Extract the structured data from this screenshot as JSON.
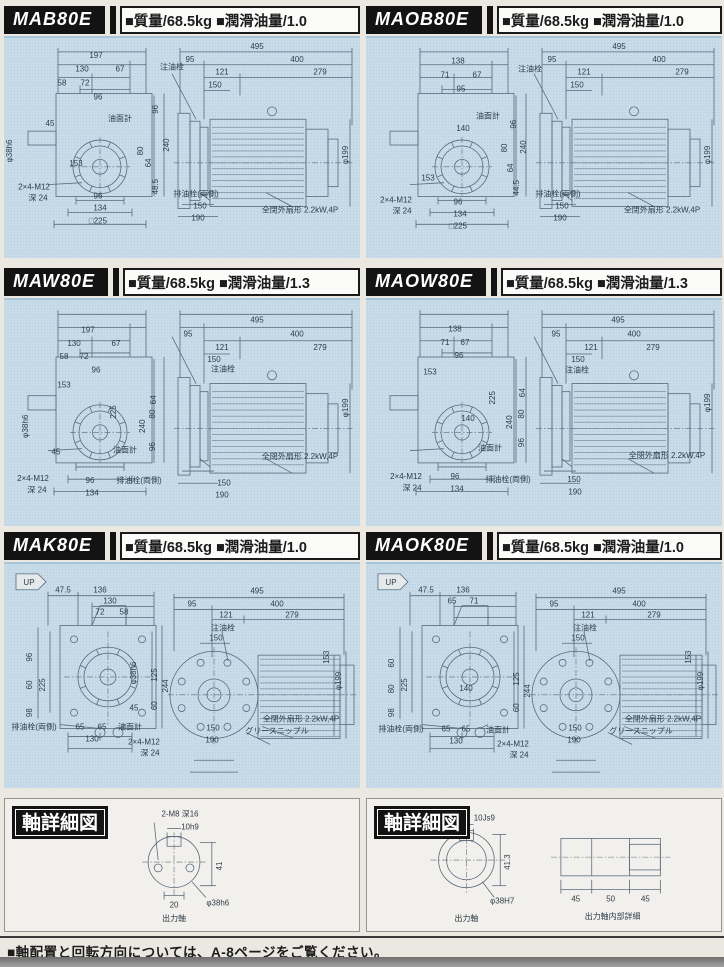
{
  "page": {
    "footer_note": "■軸配置と回転方向については、A-8ページをご覧ください。"
  },
  "colors": {
    "panel_bg": "#c7dbe9",
    "header_bg": "#131313",
    "line": "#5a6b7c",
    "label": "#2e3c49",
    "page_bg": "#ebe8e2"
  },
  "panels": [
    {
      "model": "MAB80E",
      "spec": "■質量/68.5kg ■潤滑油量/1.0",
      "family": "bw",
      "labels": [
        {
          "t": "197",
          "x": 92,
          "y": 22
        },
        {
          "t": "130",
          "x": 78,
          "y": 36
        },
        {
          "t": "67",
          "x": 116,
          "y": 36
        },
        {
          "t": "58",
          "x": 58,
          "y": 50
        },
        {
          "t": "72",
          "x": 81,
          "y": 50
        },
        {
          "t": "96",
          "x": 94,
          "y": 64
        },
        {
          "t": "注油栓",
          "x": 168,
          "y": 34
        },
        {
          "t": "45",
          "x": 46,
          "y": 91
        },
        {
          "t": "油面計",
          "x": 116,
          "y": 86
        },
        {
          "t": "φ38h6",
          "x": 8,
          "y": 116,
          "r": 1
        },
        {
          "t": "153",
          "x": 72,
          "y": 131
        },
        {
          "t": "2×4-M12",
          "x": 30,
          "y": 155
        },
        {
          "t": "深 24",
          "x": 34,
          "y": 166
        },
        {
          "t": "96",
          "x": 94,
          "y": 164
        },
        {
          "t": "134",
          "x": 96,
          "y": 176
        },
        {
          "t": "□225",
          "x": 94,
          "y": 189
        },
        {
          "t": "96",
          "x": 154,
          "y": 74,
          "r": 1
        },
        {
          "t": "240",
          "x": 165,
          "y": 110,
          "r": 1
        },
        {
          "t": "80",
          "x": 139,
          "y": 116,
          "r": 1
        },
        {
          "t": "64",
          "x": 147,
          "y": 128,
          "r": 1
        },
        {
          "t": "48.5",
          "x": 154,
          "y": 152,
          "r": 1
        },
        {
          "t": "495",
          "x": 253,
          "y": 13
        },
        {
          "t": "95",
          "x": 186,
          "y": 26
        },
        {
          "t": "400",
          "x": 293,
          "y": 26
        },
        {
          "t": "121",
          "x": 218,
          "y": 39
        },
        {
          "t": "279",
          "x": 316,
          "y": 39
        },
        {
          "t": "150",
          "x": 211,
          "y": 52
        },
        {
          "t": "φ199",
          "x": 344,
          "y": 120,
          "r": 1
        },
        {
          "t": "排油栓(両側)",
          "x": 192,
          "y": 162
        },
        {
          "t": "150",
          "x": 196,
          "y": 174
        },
        {
          "t": "190",
          "x": 194,
          "y": 186
        },
        {
          "t": "全閉外扇形 2.2kW,4P",
          "x": 296,
          "y": 178
        }
      ]
    },
    {
      "model": "MAOB80E",
      "spec": "■質量/68.5kg ■潤滑油量/1.0",
      "family": "bw",
      "labels": [
        {
          "t": "138",
          "x": 92,
          "y": 28
        },
        {
          "t": "71",
          "x": 79,
          "y": 42
        },
        {
          "t": "67",
          "x": 111,
          "y": 42
        },
        {
          "t": "95",
          "x": 95,
          "y": 56
        },
        {
          "t": "140",
          "x": 97,
          "y": 96
        },
        {
          "t": "油面計",
          "x": 122,
          "y": 83
        },
        {
          "t": "96",
          "x": 150,
          "y": 89,
          "r": 1
        },
        {
          "t": "80",
          "x": 141,
          "y": 113,
          "r": 1
        },
        {
          "t": "64",
          "x": 147,
          "y": 133,
          "r": 1
        },
        {
          "t": "240",
          "x": 160,
          "y": 112,
          "r": 1
        },
        {
          "t": "44.5",
          "x": 153,
          "y": 153,
          "r": 1
        },
        {
          "t": "153",
          "x": 62,
          "y": 146
        },
        {
          "t": "2×4-M12",
          "x": 30,
          "y": 168
        },
        {
          "t": "深 24",
          "x": 36,
          "y": 179
        },
        {
          "t": "96",
          "x": 92,
          "y": 170
        },
        {
          "t": "134",
          "x": 94,
          "y": 182
        },
        {
          "t": "□225",
          "x": 92,
          "y": 194
        },
        {
          "t": "注油栓",
          "x": 164,
          "y": 36
        },
        {
          "t": "495",
          "x": 253,
          "y": 13
        },
        {
          "t": "95",
          "x": 186,
          "y": 26
        },
        {
          "t": "400",
          "x": 293,
          "y": 26
        },
        {
          "t": "121",
          "x": 218,
          "y": 39
        },
        {
          "t": "279",
          "x": 316,
          "y": 39
        },
        {
          "t": "150",
          "x": 211,
          "y": 52
        },
        {
          "t": "φ199",
          "x": 344,
          "y": 120,
          "r": 1
        },
        {
          "t": "排油栓(両側)",
          "x": 192,
          "y": 162
        },
        {
          "t": "150",
          "x": 196,
          "y": 174
        },
        {
          "t": "190",
          "x": 194,
          "y": 186
        },
        {
          "t": "全閉外扇形 2.2kW,4P",
          "x": 296,
          "y": 178
        }
      ]
    },
    {
      "model": "MAW80E",
      "spec": "■質量/68.5kg ■潤滑油量/1.3",
      "family": "bw",
      "labels": [
        {
          "t": "197",
          "x": 84,
          "y": 34
        },
        {
          "t": "130",
          "x": 70,
          "y": 47
        },
        {
          "t": "67",
          "x": 112,
          "y": 47
        },
        {
          "t": "58",
          "x": 60,
          "y": 60
        },
        {
          "t": "72",
          "x": 80,
          "y": 60
        },
        {
          "t": "96",
          "x": 92,
          "y": 73
        },
        {
          "t": "153",
          "x": 60,
          "y": 88
        },
        {
          "t": "225",
          "x": 112,
          "y": 112,
          "r": 1
        },
        {
          "t": "φ38h6",
          "x": 24,
          "y": 126,
          "r": 1
        },
        {
          "t": "45",
          "x": 52,
          "y": 154
        },
        {
          "t": "2×4-M12",
          "x": 29,
          "y": 180
        },
        {
          "t": "深 24",
          "x": 33,
          "y": 191
        },
        {
          "t": "96",
          "x": 86,
          "y": 182
        },
        {
          "t": "134",
          "x": 88,
          "y": 194
        },
        {
          "t": "油面計",
          "x": 121,
          "y": 152
        },
        {
          "t": "排油栓(両側)",
          "x": 135,
          "y": 182
        },
        {
          "t": "64",
          "x": 152,
          "y": 100,
          "r": 1
        },
        {
          "t": "80",
          "x": 151,
          "y": 114,
          "r": 1
        },
        {
          "t": "240",
          "x": 141,
          "y": 126,
          "r": 1
        },
        {
          "t": "96",
          "x": 151,
          "y": 146,
          "r": 1
        },
        {
          "t": "495",
          "x": 253,
          "y": 24
        },
        {
          "t": "95",
          "x": 184,
          "y": 38
        },
        {
          "t": "400",
          "x": 293,
          "y": 38
        },
        {
          "t": "121",
          "x": 218,
          "y": 51
        },
        {
          "t": "279",
          "x": 316,
          "y": 51
        },
        {
          "t": "注油栓",
          "x": 219,
          "y": 72
        },
        {
          "t": "150",
          "x": 210,
          "y": 63
        },
        {
          "t": "φ199",
          "x": 344,
          "y": 108,
          "r": 1
        },
        {
          "t": "全閉外扇形 2.2kW,4P",
          "x": 296,
          "y": 158
        },
        {
          "t": "150",
          "x": 220,
          "y": 184
        },
        {
          "t": "190",
          "x": 218,
          "y": 196
        }
      ]
    },
    {
      "model": "MAOW80E",
      "spec": "■質量/68.5kg ■潤滑油量/1.3",
      "family": "bw",
      "labels": [
        {
          "t": "138",
          "x": 89,
          "y": 33
        },
        {
          "t": "71",
          "x": 79,
          "y": 46
        },
        {
          "t": "67",
          "x": 99,
          "y": 46
        },
        {
          "t": "96",
          "x": 93,
          "y": 59
        },
        {
          "t": "153",
          "x": 64,
          "y": 75
        },
        {
          "t": "225",
          "x": 129,
          "y": 98,
          "r": 1
        },
        {
          "t": "140",
          "x": 102,
          "y": 121
        },
        {
          "t": "油面計",
          "x": 124,
          "y": 150
        },
        {
          "t": "2×4-M12",
          "x": 40,
          "y": 178
        },
        {
          "t": "深 24",
          "x": 46,
          "y": 189
        },
        {
          "t": "96",
          "x": 89,
          "y": 178
        },
        {
          "t": "134",
          "x": 91,
          "y": 190
        },
        {
          "t": "排油栓(両側)",
          "x": 142,
          "y": 181
        },
        {
          "t": "64",
          "x": 159,
          "y": 93,
          "r": 1
        },
        {
          "t": "80",
          "x": 158,
          "y": 114,
          "r": 1
        },
        {
          "t": "96",
          "x": 158,
          "y": 142,
          "r": 1
        },
        {
          "t": "240",
          "x": 146,
          "y": 122,
          "r": 1
        },
        {
          "t": "495",
          "x": 252,
          "y": 24
        },
        {
          "t": "95",
          "x": 190,
          "y": 38
        },
        {
          "t": "400",
          "x": 268,
          "y": 38
        },
        {
          "t": "121",
          "x": 225,
          "y": 51
        },
        {
          "t": "279",
          "x": 287,
          "y": 51
        },
        {
          "t": "150",
          "x": 212,
          "y": 63
        },
        {
          "t": "注油栓",
          "x": 211,
          "y": 73
        },
        {
          "t": "φ199",
          "x": 344,
          "y": 103,
          "r": 1
        },
        {
          "t": "全閉外扇形 2.2kW,4P",
          "x": 301,
          "y": 157
        },
        {
          "t": "150",
          "x": 208,
          "y": 181
        },
        {
          "t": "190",
          "x": 209,
          "y": 193
        }
      ]
    },
    {
      "model": "MAK80E",
      "spec": "■質量/68.5kg ■潤滑油量/1.0",
      "family": "k",
      "labels": [
        {
          "t": "UP",
          "x": 25,
          "y": 23
        },
        {
          "t": "47.5",
          "x": 59,
          "y": 31
        },
        {
          "t": "136",
          "x": 96,
          "y": 31
        },
        {
          "t": "130",
          "x": 106,
          "y": 42
        },
        {
          "t": "72",
          "x": 96,
          "y": 53
        },
        {
          "t": "58",
          "x": 120,
          "y": 53
        },
        {
          "t": "96",
          "x": 28,
          "y": 96,
          "r": 1
        },
        {
          "t": "60",
          "x": 28,
          "y": 124,
          "r": 1
        },
        {
          "t": "98",
          "x": 28,
          "y": 152,
          "r": 1
        },
        {
          "t": "225",
          "x": 41,
          "y": 124,
          "r": 1
        },
        {
          "t": "φ38h6",
          "x": 132,
          "y": 112,
          "r": 1
        },
        {
          "t": "45",
          "x": 130,
          "y": 150
        },
        {
          "t": "244",
          "x": 164,
          "y": 125,
          "r": 1
        },
        {
          "t": "125",
          "x": 153,
          "y": 114,
          "r": 1
        },
        {
          "t": "60",
          "x": 153,
          "y": 145,
          "r": 1
        },
        {
          "t": "排油栓(両側)",
          "x": 30,
          "y": 169
        },
        {
          "t": "65",
          "x": 76,
          "y": 169
        },
        {
          "t": "65",
          "x": 98,
          "y": 169
        },
        {
          "t": "130",
          "x": 88,
          "y": 181
        },
        {
          "t": "油面計",
          "x": 126,
          "y": 169
        },
        {
          "t": "2×4-M12",
          "x": 140,
          "y": 184
        },
        {
          "t": "深 24",
          "x": 146,
          "y": 195
        },
        {
          "t": "495",
          "x": 253,
          "y": 32
        },
        {
          "t": "95",
          "x": 188,
          "y": 45
        },
        {
          "t": "400",
          "x": 273,
          "y": 45
        },
        {
          "t": "121",
          "x": 222,
          "y": 56
        },
        {
          "t": "279",
          "x": 288,
          "y": 56
        },
        {
          "t": "注油栓",
          "x": 219,
          "y": 69
        },
        {
          "t": "150",
          "x": 212,
          "y": 79
        },
        {
          "t": "153",
          "x": 325,
          "y": 96,
          "r": 1
        },
        {
          "t": "φ199",
          "x": 337,
          "y": 120,
          "r": 1
        },
        {
          "t": "全閉外扇形 2.2kW,4P",
          "x": 297,
          "y": 161
        },
        {
          "t": "グリースニップル",
          "x": 273,
          "y": 173
        },
        {
          "t": "150",
          "x": 209,
          "y": 170
        },
        {
          "t": "190",
          "x": 208,
          "y": 182
        }
      ]
    },
    {
      "model": "MAOK80E",
      "spec": "■質量/68.5kg ■潤滑油量/1.0",
      "family": "k",
      "labels": [
        {
          "t": "UP",
          "x": 25,
          "y": 23
        },
        {
          "t": "47.5",
          "x": 60,
          "y": 31
        },
        {
          "t": "136",
          "x": 97,
          "y": 31
        },
        {
          "t": "65",
          "x": 86,
          "y": 42
        },
        {
          "t": "71",
          "x": 108,
          "y": 42
        },
        {
          "t": "60",
          "x": 28,
          "y": 102,
          "r": 1
        },
        {
          "t": "80",
          "x": 28,
          "y": 128,
          "r": 1
        },
        {
          "t": "98",
          "x": 28,
          "y": 152,
          "r": 1
        },
        {
          "t": "225",
          "x": 41,
          "y": 124,
          "r": 1
        },
        {
          "t": "140",
          "x": 100,
          "y": 130
        },
        {
          "t": "244",
          "x": 164,
          "y": 130,
          "r": 1
        },
        {
          "t": "125",
          "x": 153,
          "y": 118,
          "r": 1
        },
        {
          "t": "60",
          "x": 153,
          "y": 147,
          "r": 1
        },
        {
          "t": "排油栓(両側)",
          "x": 35,
          "y": 171
        },
        {
          "t": "65",
          "x": 80,
          "y": 171
        },
        {
          "t": "65",
          "x": 100,
          "y": 171
        },
        {
          "t": "130",
          "x": 90,
          "y": 183
        },
        {
          "t": "油面計",
          "x": 132,
          "y": 172
        },
        {
          "t": "2×4-M12",
          "x": 147,
          "y": 186
        },
        {
          "t": "深 24",
          "x": 153,
          "y": 197
        },
        {
          "t": "495",
          "x": 253,
          "y": 32
        },
        {
          "t": "95",
          "x": 188,
          "y": 45
        },
        {
          "t": "400",
          "x": 273,
          "y": 45
        },
        {
          "t": "121",
          "x": 222,
          "y": 56
        },
        {
          "t": "279",
          "x": 288,
          "y": 56
        },
        {
          "t": "注油栓",
          "x": 219,
          "y": 69
        },
        {
          "t": "150",
          "x": 212,
          "y": 79
        },
        {
          "t": "153",
          "x": 325,
          "y": 96,
          "r": 1
        },
        {
          "t": "φ199",
          "x": 337,
          "y": 120,
          "r": 1
        },
        {
          "t": "全閉外扇形 2.2kW,4P",
          "x": 297,
          "y": 161
        },
        {
          "t": "グリースニップル",
          "x": 275,
          "y": 173
        },
        {
          "t": "150",
          "x": 209,
          "y": 170
        },
        {
          "t": "190",
          "x": 208,
          "y": 182
        }
      ]
    }
  ],
  "shaft_panels": [
    {
      "title": "軸詳細図",
      "family": "shaftL",
      "labels": [
        {
          "t": "2-M8 深16",
          "x": 176,
          "y": 18
        },
        {
          "t": "10h9",
          "x": 186,
          "y": 31
        },
        {
          "t": "41",
          "x": 218,
          "y": 68,
          "r": 1
        },
        {
          "t": "20",
          "x": 170,
          "y": 110
        },
        {
          "t": "φ38h6",
          "x": 214,
          "y": 108
        },
        {
          "t": "出力軸",
          "x": 170,
          "y": 124
        }
      ]
    },
    {
      "title": "軸詳細図",
      "family": "shaftR",
      "labels": [
        {
          "t": "10Js9",
          "x": 118,
          "y": 22
        },
        {
          "t": "41.3",
          "x": 144,
          "y": 64,
          "r": 1
        },
        {
          "t": "φ38H7",
          "x": 136,
          "y": 106
        },
        {
          "t": "出力軸",
          "x": 100,
          "y": 124
        },
        {
          "t": "45",
          "x": 210,
          "y": 104
        },
        {
          "t": "50",
          "x": 245,
          "y": 104
        },
        {
          "t": "45",
          "x": 280,
          "y": 104
        },
        {
          "t": "出力軸内部詳細",
          "x": 247,
          "y": 122
        }
      ]
    }
  ]
}
